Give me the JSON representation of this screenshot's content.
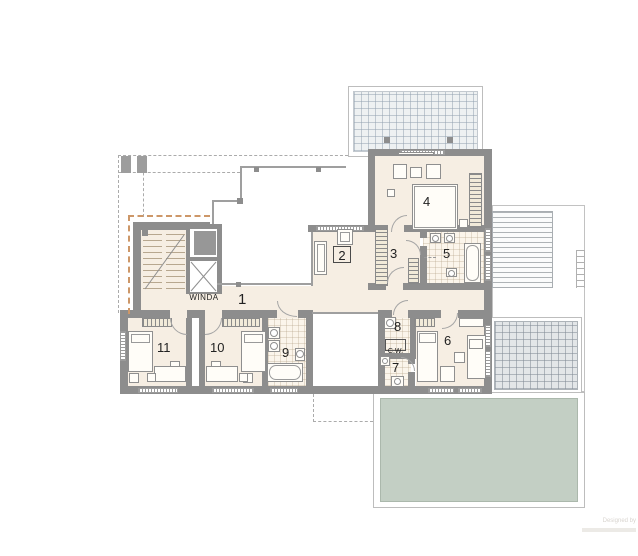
{
  "colors": {
    "wall": "#8d8d8d",
    "floor": "#f6eee3",
    "tile_floor": "#fbf5eb",
    "terrace": "#eef1f2",
    "terrace_lower": "#e3e6e8",
    "green_roof": "#c3cfc4",
    "insulation_dash": "#cd9768",
    "line": "#9f9f9f"
  },
  "labels": {
    "hall": "1",
    "sitting": "2",
    "corridor": "3",
    "master_bedroom": "4",
    "master_bath": "5",
    "bedroom_right": "6",
    "wc": "7",
    "utility": "8",
    "bathroom": "9",
    "bedroom_mid": "10",
    "bedroom_left": "11",
    "elevator": "WINDA",
    "hot_water": "C.W."
  },
  "watermark": {
    "credit": "Designed by"
  }
}
